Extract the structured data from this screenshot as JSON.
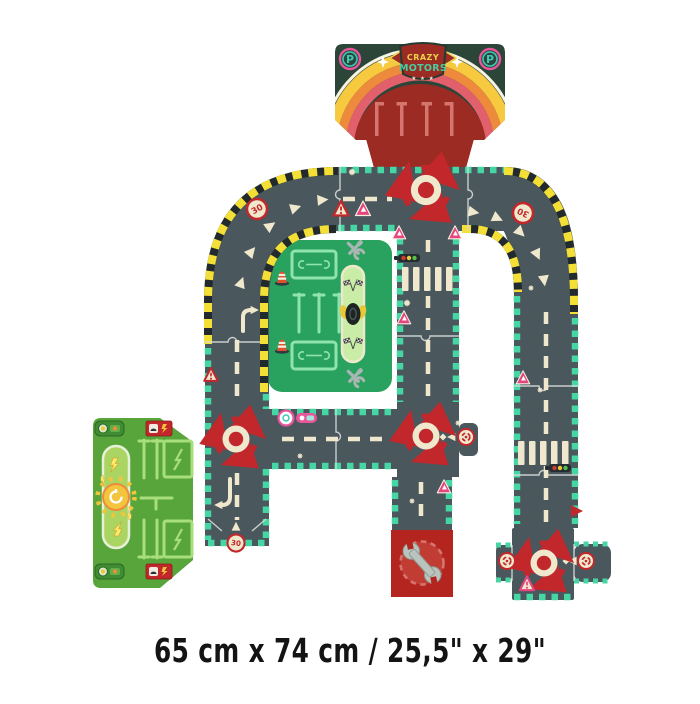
{
  "caption": {
    "dimensions_text": "65 cm x 74 cm / 25,5\" x 29\""
  },
  "garage": {
    "logo_line1": "CRAZY",
    "logo_line2": "MOTORS",
    "logo_stars": "★ ★ ★",
    "parking_letter": "P"
  },
  "road_signs": {
    "speed_limit": "30"
  },
  "palette": {
    "background": "#ffffff",
    "road": "#4a575d",
    "mint_edge": "#45d6a4",
    "marking_cream": "#efe8cd",
    "hazard_yellow": "#f3df36",
    "hazard_black": "#232a2e",
    "sign_red": "#c2272b",
    "sign_pink": "#e5457e",
    "pink_ring": "#e8559a",
    "teal": "#3fc9b8",
    "garage_green": "#2b4639",
    "garage_red": "#9c2b24",
    "rainbow_yellow": "#f6c93e",
    "rainbow_orange": "#ee8a3c",
    "rainbow_pink": "#e2606b",
    "pit_green": "#29a15f",
    "pit_light_green": "#8fe3ac",
    "pit_pill": "#c9eda6",
    "grass_green": "#57a53b",
    "charge_pill": "#abd563",
    "charge_lines": "#a8de7c",
    "sun_yellow": "#f2c53d",
    "tool_gray": "#a9b6b2",
    "repair_red": "#b5251f",
    "dashed_pink": "#d4766e",
    "caption_text": "#141414"
  },
  "icons": {
    "parking-sign": "letter P in ringed circle",
    "speed-sign": "30 in red-ringed circle",
    "roundabout": "red circular arrows around center dot",
    "roundabout-mini-sign": "red ring with circular arrows",
    "warning-triangle": "red/pink triangle road sign",
    "traffic-light-icon": "horizontal 3-dot signal",
    "crosswalk": "zebra stripes",
    "direction-arrow": "cream triangle",
    "wrench-icon": "large repair wrench",
    "crossed-tools-icon": "wrench and spanner crossed",
    "traffic-cone-icon": "striped cone",
    "checkered-flags-icon": "pair of racing flags",
    "tire-icon": "stack of tires",
    "charging-burst-icon": "sun with plug",
    "lightning-bolt-icon": "charging bolt",
    "charger-sign": "red sign with car and bolt",
    "rainbow-arch": "yellow orange pink arch with stars",
    "star-icon": "★"
  }
}
